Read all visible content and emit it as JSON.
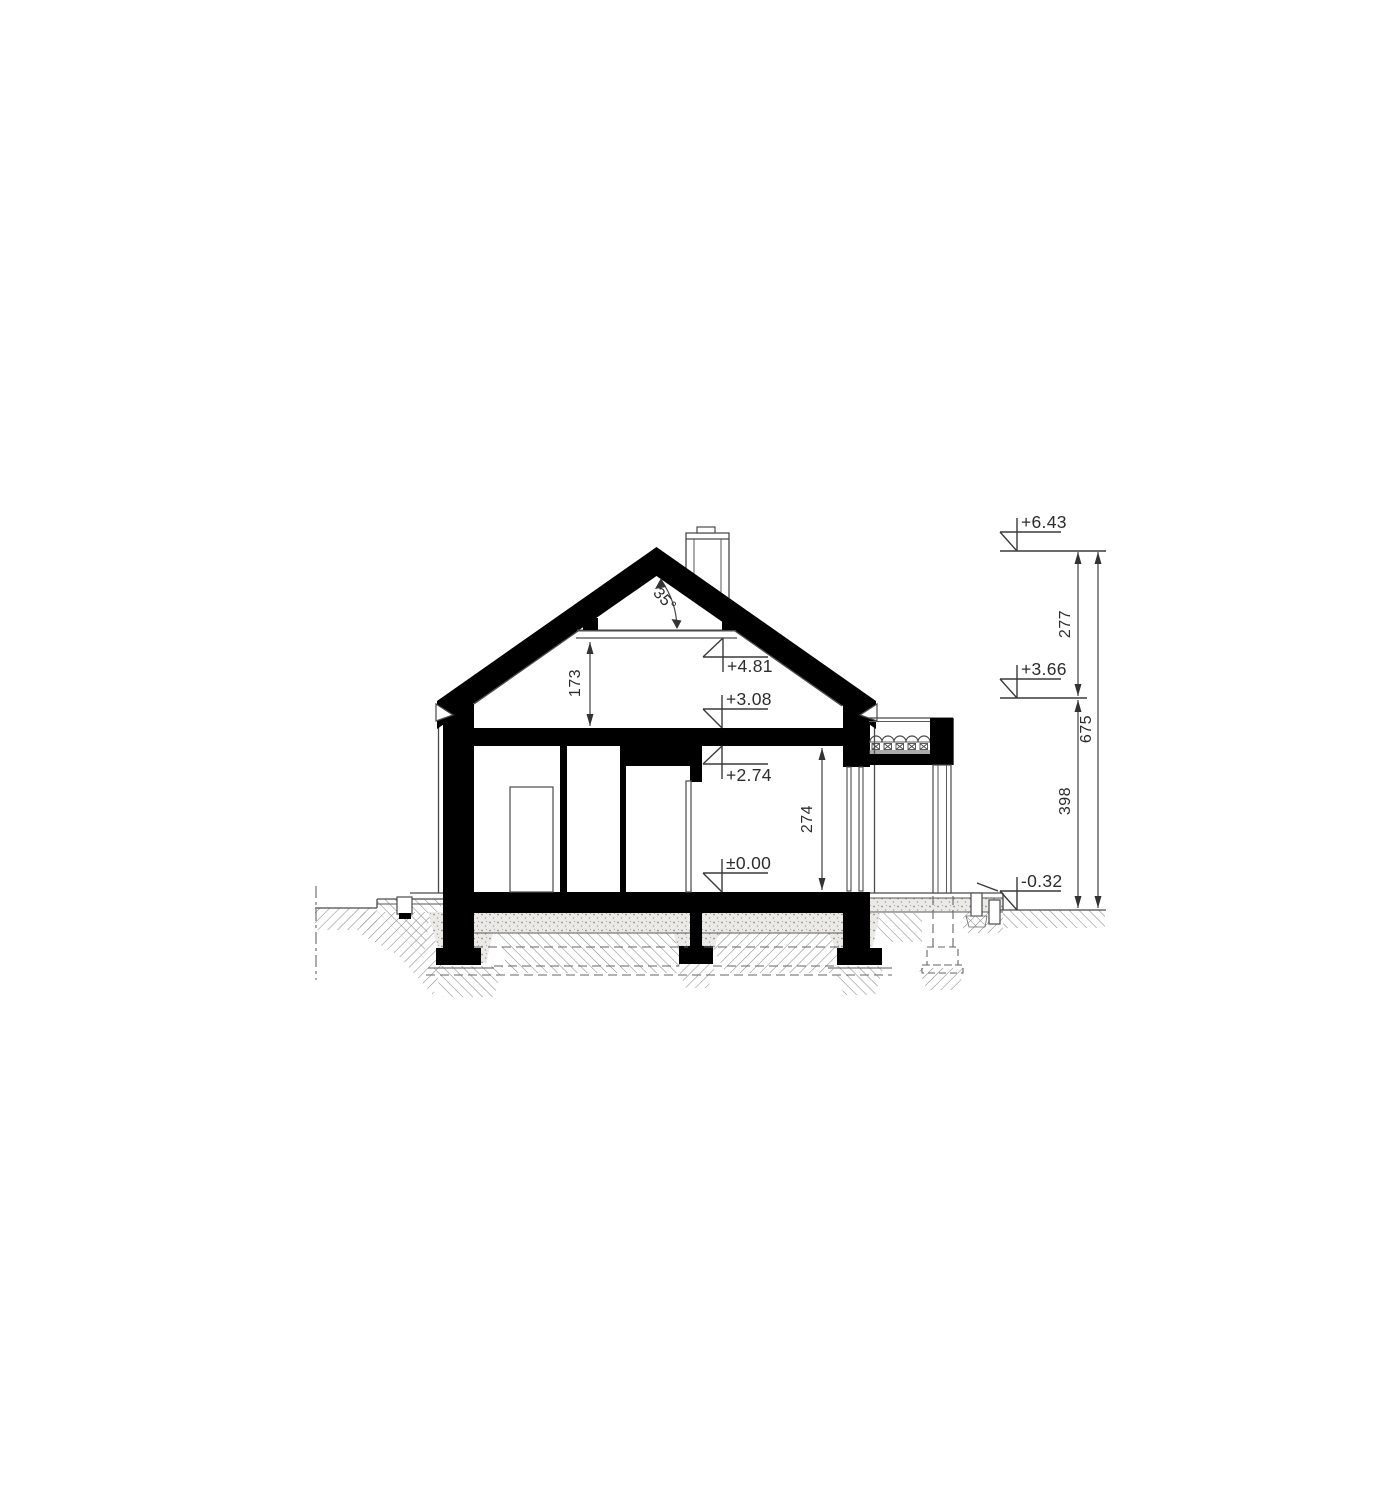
{
  "drawing": {
    "kind": "house-cross-section",
    "colors": {
      "ink": "#000000",
      "line": "#4a4a4a",
      "background": "#ffffff"
    }
  },
  "annotations": {
    "levels": {
      "ridge": "+6.43",
      "eave": "+3.66",
      "terrace": "-0.32",
      "collar": "+4.81",
      "ceiling_top": "+3.08",
      "ceiling_bottom": "+2.74",
      "floor": "±0.00"
    },
    "dimensions": {
      "ridge_to_eave": "277",
      "total_height": "675",
      "eave_to_terrace": "398",
      "attic_height": "173",
      "room_height": "274"
    },
    "roof_angle": "35°"
  }
}
